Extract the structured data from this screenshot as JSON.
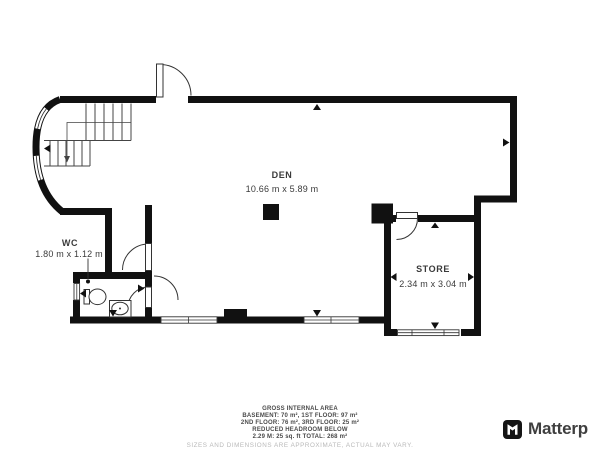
{
  "rooms": {
    "den": {
      "name": "DEN",
      "dims": "10.66 m x 5.89 m"
    },
    "wc": {
      "name": "WC",
      "dims": "1.80 m x 1.12 m"
    },
    "store": {
      "name": "STORE",
      "dims": "2.34 m x 3.04 m"
    }
  },
  "footer": {
    "title": "GROSS INTERNAL AREA",
    "line_floors_1": "BASEMENT: 70 m², 1ST FLOOR: 97 m²",
    "line_floors_2": "2ND FLOOR: 76 m², 3RD FLOOR: 25 m²",
    "line_reduced": "REDUCED HEADROOM BELOW",
    "line_total": "2.29 M: 25 sq. ft TOTAL: 268 m²",
    "disclaimer": "SIZES AND DIMENSIONS ARE APPROXIMATE, ACTUAL MAY VARY."
  },
  "branding": {
    "logo_text": "Matterp",
    "icon": "matterport-flag-icon"
  },
  "colors": {
    "wall": "#111111",
    "thin_line": "#333333",
    "label_text": "#3a3a3a",
    "footer_text": "#4a4a4a",
    "disclaimer_text": "#b9b9b9",
    "logo_text": "#3f3f3f",
    "background": "#ffffff"
  }
}
